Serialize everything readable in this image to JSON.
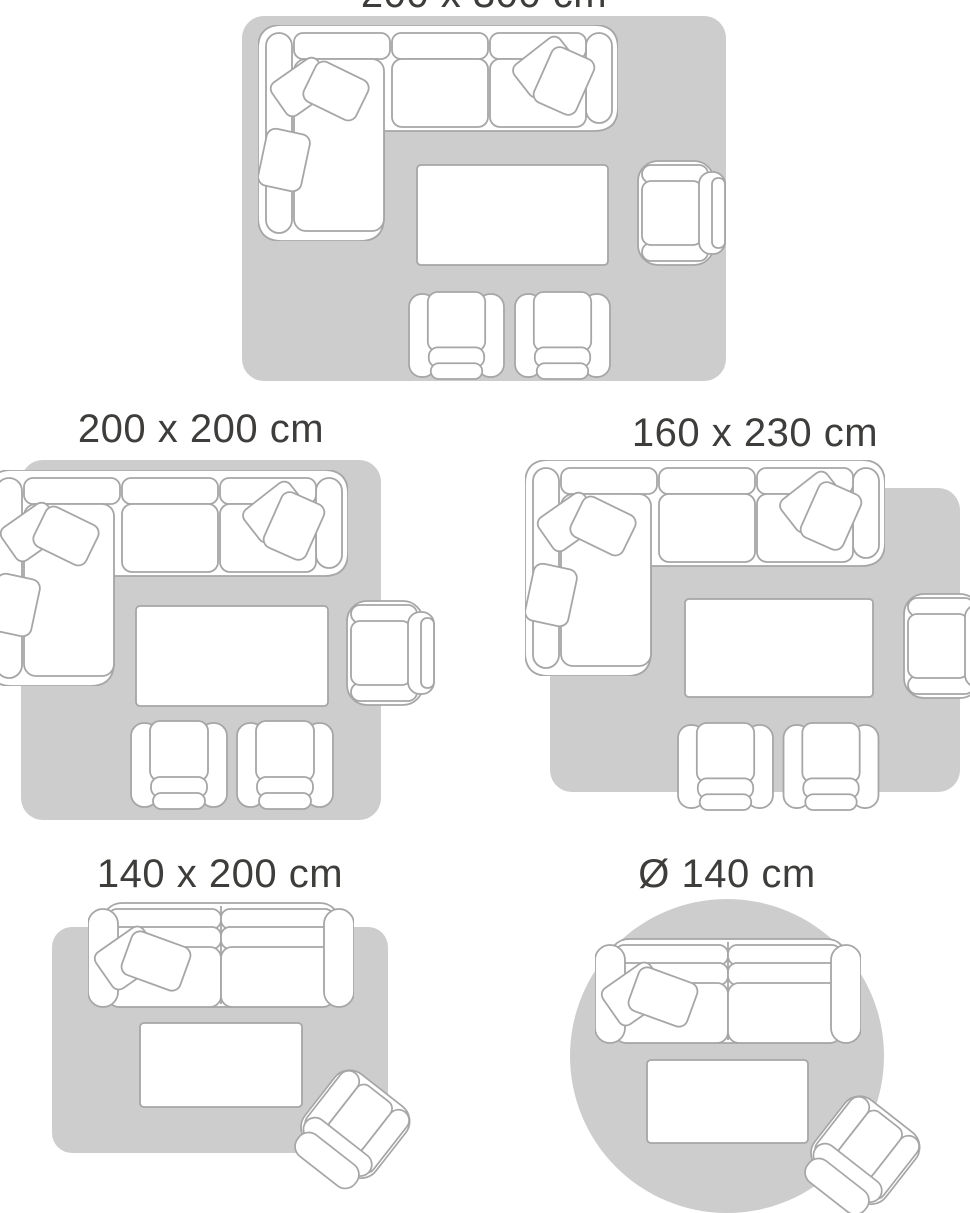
{
  "colors": {
    "rug": "#cdcdcd",
    "outline": "#a6a6a6",
    "fill": "#ffffff",
    "text": "#3e3d3b",
    "bg": "#ffffff"
  },
  "layouts": [
    {
      "id": "rug-200x300",
      "label": "200 x 300 cm",
      "shape": "rectangle",
      "furniture": [
        "corner-sofa",
        "coffee-table",
        "armchair",
        "small-armchair",
        "small-armchair"
      ]
    },
    {
      "id": "rug-200x200",
      "label": "200 x 200 cm",
      "shape": "rectangle",
      "furniture": [
        "corner-sofa",
        "coffee-table",
        "armchair",
        "small-armchair",
        "small-armchair"
      ]
    },
    {
      "id": "rug-160x230",
      "label": "160 x 230 cm",
      "shape": "rectangle",
      "furniture": [
        "corner-sofa",
        "coffee-table",
        "armchair",
        "small-armchair",
        "small-armchair"
      ]
    },
    {
      "id": "rug-140x200",
      "label": "140 x 200 cm",
      "shape": "rectangle",
      "furniture": [
        "two-seat-sofa",
        "coffee-table",
        "tilted-armchair"
      ]
    },
    {
      "id": "rug-d140",
      "label": "Ø 140 cm",
      "shape": "circle",
      "furniture": [
        "two-seat-sofa",
        "coffee-table",
        "tilted-armchair"
      ]
    }
  ]
}
